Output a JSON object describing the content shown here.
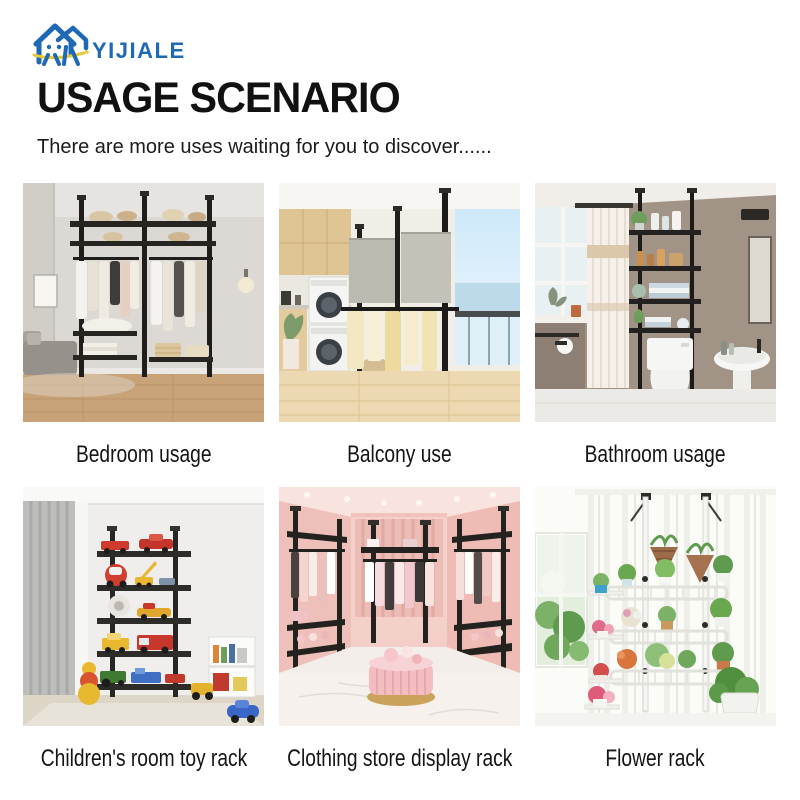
{
  "brand": {
    "name": "YIJIALE",
    "logo_blue": "#1e68b5",
    "logo_yellow": "#e9c83d"
  },
  "header": {
    "title": "USAGE SCENARIO",
    "subtitle": "There are more uses waiting for you to discover......"
  },
  "scenarios": [
    {
      "caption": "Bedroom usage",
      "image": "bedroom with floor-to-ceiling black pole clothes rack"
    },
    {
      "caption": "Balcony use",
      "image": "balcony drying rack beside stacked washer and dryer"
    },
    {
      "caption": "Bathroom usage",
      "image": "over-toilet tension pole shelving with toiletries"
    },
    {
      "caption": "Children's room toy rack",
      "image": "five-tier black rack filled with toy cars"
    },
    {
      "caption": "Clothing store display rack",
      "image": "pink boutique with three garment racks and ottoman"
    },
    {
      "caption": "Flower rack",
      "image": "white tension pole plant rack in front of sheer curtains"
    }
  ],
  "colors": {
    "title_black": "#111111",
    "caption_black": "#141414",
    "background": "#ffffff"
  }
}
